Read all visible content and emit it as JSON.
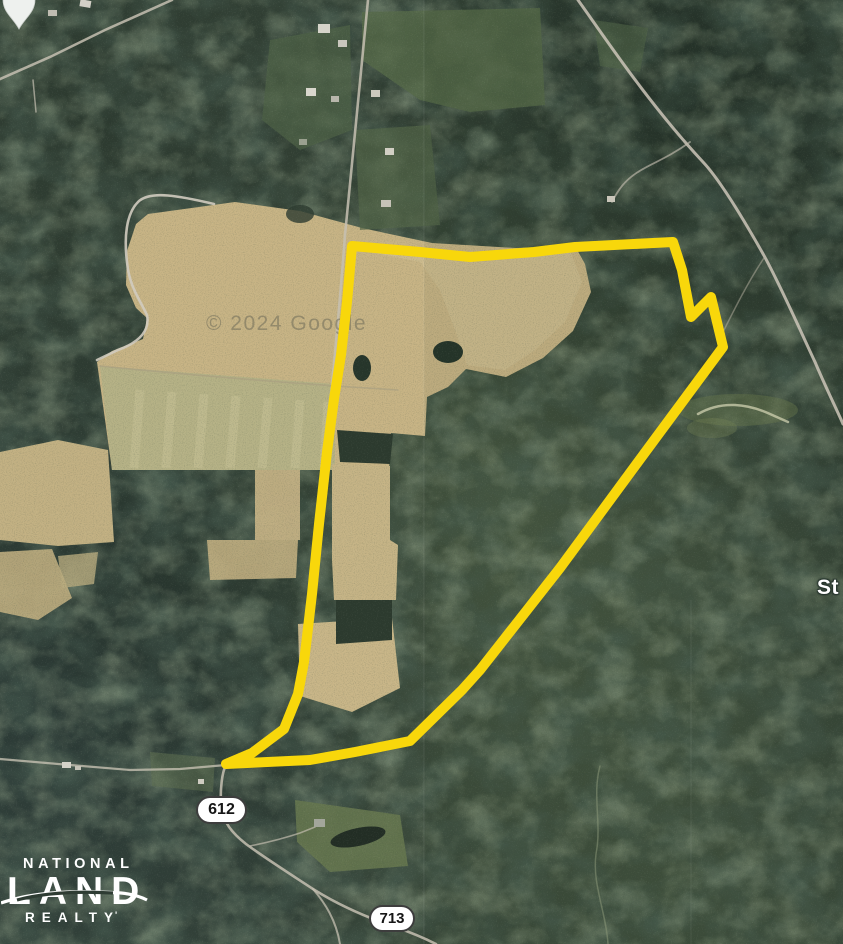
{
  "map": {
    "attribution": "© 2024 Google",
    "place_label": "St",
    "road_shields": [
      "612",
      "713"
    ],
    "boundary_color": "#F8D70B"
  },
  "logo": {
    "line1": "NATIONAL",
    "line2": "LAND",
    "line3": "REALTY",
    "trademark": "'"
  }
}
